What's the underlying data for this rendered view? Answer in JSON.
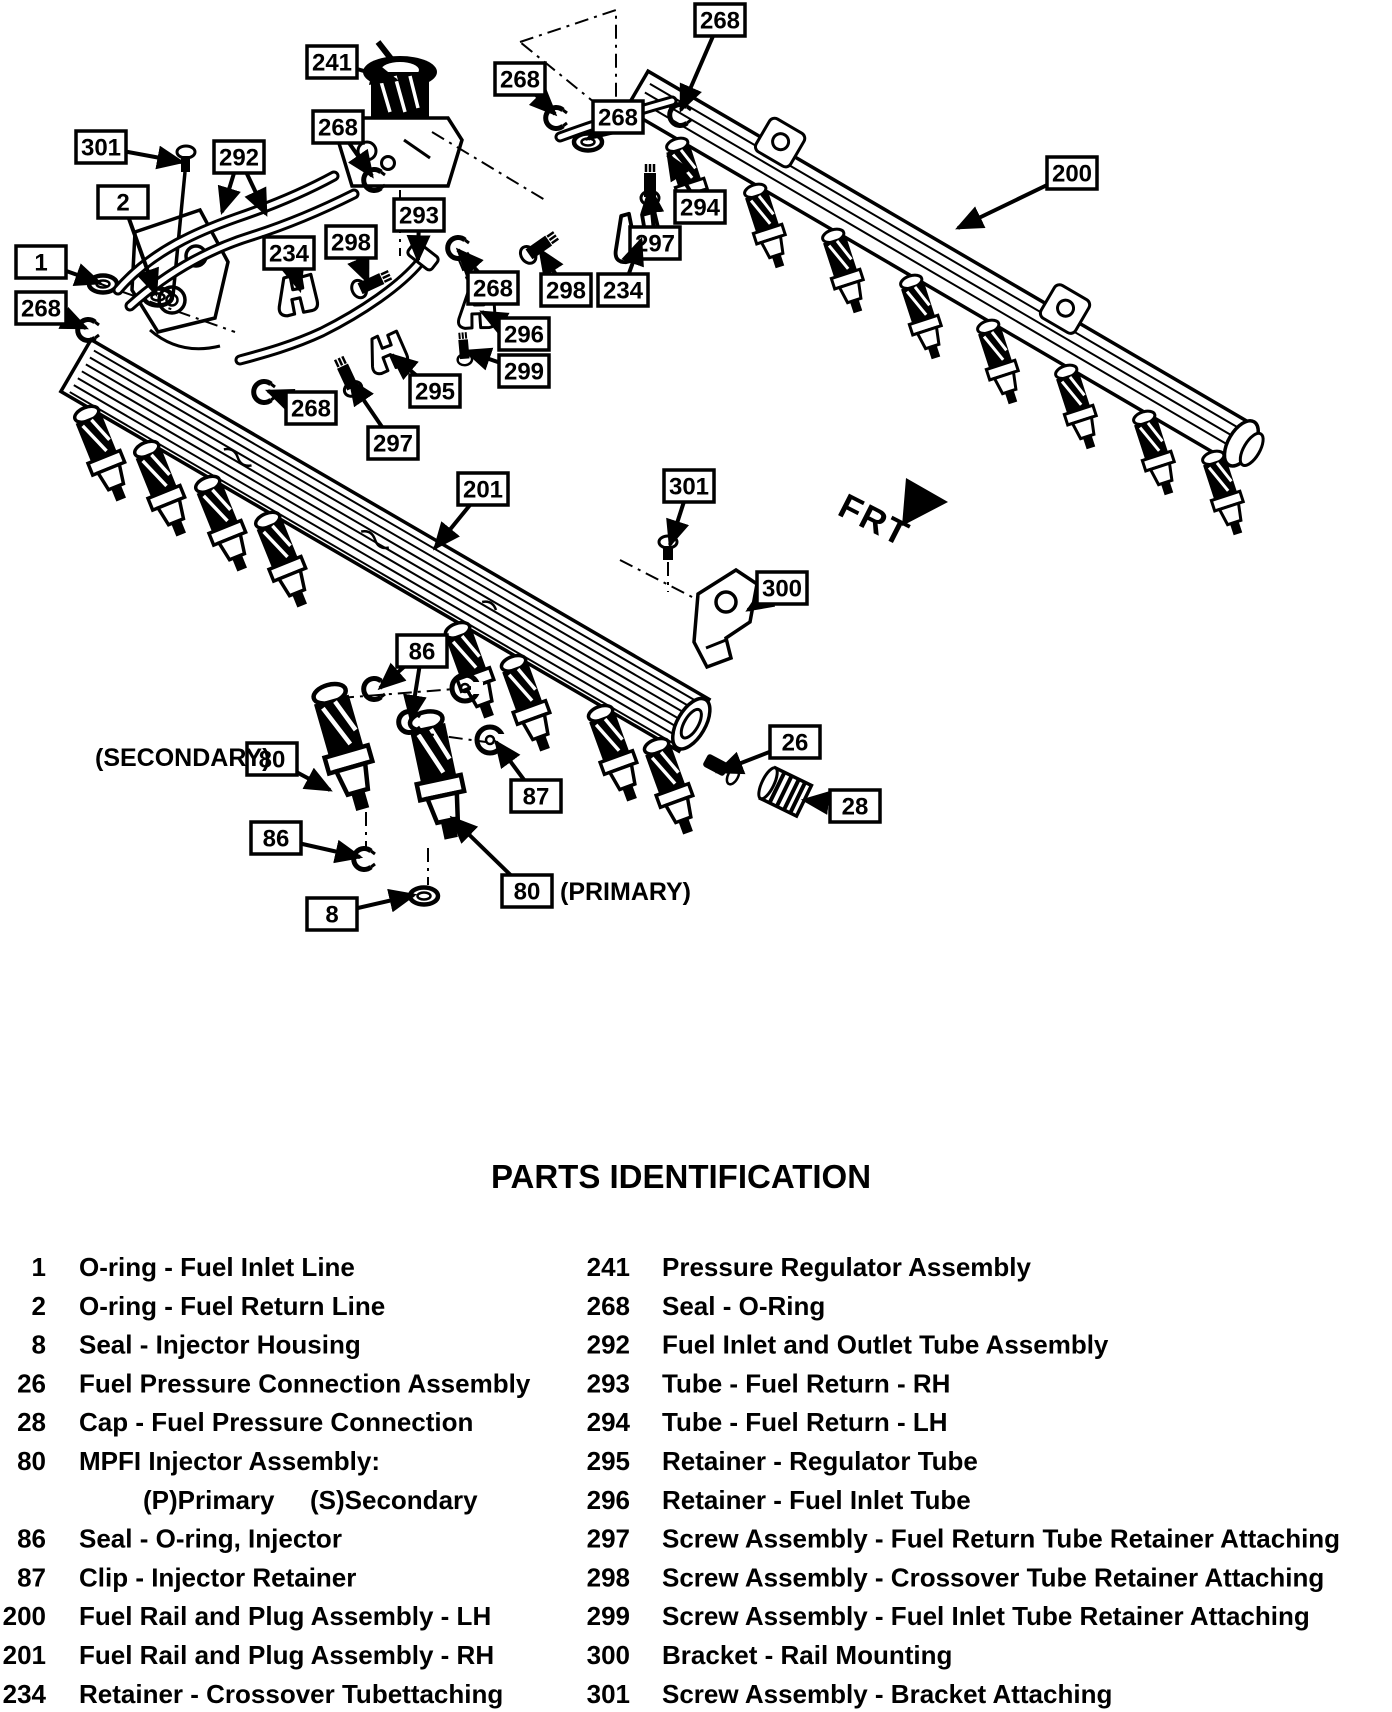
{
  "figure": {
    "orientation_label": "FRT",
    "secondary_label": "(SECONDARY)",
    "primary_label": "(PRIMARY)",
    "callouts": [
      {
        "id": "241",
        "label": "241",
        "x": 332,
        "y": 62,
        "arrows": [
          [
            396,
            80
          ]
        ]
      },
      {
        "id": "268-regulator",
        "label": "268",
        "x": 338,
        "y": 127,
        "arrows": [
          [
            372,
            176
          ]
        ]
      },
      {
        "id": "301-screw",
        "label": "301",
        "x": 101,
        "y": 147,
        "arrows": [
          [
            182,
            162
          ]
        ]
      },
      {
        "id": "292",
        "label": "292",
        "x": 239,
        "y": 157,
        "arrows": [
          [
            222,
            212
          ],
          [
            266,
            214
          ]
        ]
      },
      {
        "id": "2",
        "label": "2",
        "x": 123,
        "y": 202,
        "arrows": [
          [
            156,
            294
          ]
        ]
      },
      {
        "id": "1",
        "label": "1",
        "x": 41,
        "y": 262,
        "arrows": [
          [
            100,
            283
          ]
        ]
      },
      {
        "id": "268-left",
        "label": "268",
        "x": 41,
        "y": 308,
        "arrows": [
          [
            86,
            328
          ]
        ]
      },
      {
        "id": "293",
        "label": "293",
        "x": 419,
        "y": 215,
        "arrows": [
          [
            418,
            260
          ]
        ]
      },
      {
        "id": "234-left",
        "label": "234",
        "x": 289,
        "y": 253,
        "arrows": [
          [
            300,
            290
          ]
        ]
      },
      {
        "id": "298-left",
        "label": "298",
        "x": 351,
        "y": 242,
        "arrows": [
          [
            368,
            282
          ]
        ]
      },
      {
        "id": "268-crossover",
        "label": "268",
        "x": 493,
        "y": 288,
        "arrows": [
          [
            458,
            250
          ]
        ]
      },
      {
        "id": "296",
        "label": "296",
        "x": 524,
        "y": 334,
        "arrows": [
          [
            482,
            312
          ]
        ]
      },
      {
        "id": "299",
        "label": "299",
        "x": 524,
        "y": 371,
        "arrows": [
          [
            466,
            351
          ]
        ]
      },
      {
        "id": "295",
        "label": "295",
        "x": 435,
        "y": 391,
        "arrows": [
          [
            392,
            355
          ]
        ]
      },
      {
        "id": "268-return",
        "label": "268",
        "x": 311,
        "y": 408,
        "arrows": [
          [
            268,
            391
          ]
        ]
      },
      {
        "id": "297-return",
        "label": "297",
        "x": 393,
        "y": 443,
        "arrows": [
          [
            350,
            380
          ]
        ]
      },
      {
        "id": "268-top-mid",
        "label": "268",
        "x": 520,
        "y": 79,
        "arrows": [
          [
            555,
            114
          ]
        ]
      },
      {
        "id": "268-top-right",
        "label": "268",
        "x": 618,
        "y": 117,
        "arrows": [
          [
            588,
            139
          ]
        ]
      },
      {
        "id": "268-rail-top",
        "label": "268",
        "x": 720,
        "y": 20,
        "arrows": [
          [
            681,
            110
          ]
        ]
      },
      {
        "id": "294",
        "label": "294",
        "x": 700,
        "y": 207,
        "arrows": [
          [
            668,
            155
          ]
        ]
      },
      {
        "id": "297-right",
        "label": "297",
        "x": 655,
        "y": 243,
        "arrows": [
          [
            650,
            188
          ]
        ]
      },
      {
        "id": "234-right",
        "label": "234",
        "x": 623,
        "y": 290,
        "arrows": [
          [
            641,
            240
          ]
        ]
      },
      {
        "id": "298-right",
        "label": "298",
        "x": 566,
        "y": 290,
        "arrows": [
          [
            540,
            250
          ]
        ]
      },
      {
        "id": "200",
        "label": "200",
        "x": 1072,
        "y": 173,
        "arrows": [
          [
            958,
            228
          ]
        ]
      },
      {
        "id": "201",
        "label": "201",
        "x": 483,
        "y": 489,
        "arrows": [
          [
            435,
            548
          ]
        ]
      },
      {
        "id": "301-bracket",
        "label": "301",
        "x": 689,
        "y": 486,
        "arrows": [
          [
            670,
            545
          ]
        ]
      },
      {
        "id": "300",
        "label": "300",
        "x": 782,
        "y": 588,
        "arrows": [
          [
            748,
            610
          ]
        ]
      },
      {
        "id": "26",
        "label": "26",
        "x": 795,
        "y": 742,
        "arrows": [
          [
            718,
            772
          ]
        ]
      },
      {
        "id": "28",
        "label": "28",
        "x": 855,
        "y": 806,
        "arrows": [
          [
            804,
            800
          ]
        ]
      },
      {
        "id": "86-top",
        "label": "86",
        "x": 422,
        "y": 651,
        "arrows": [
          [
            380,
            688
          ],
          [
            411,
            720
          ]
        ]
      },
      {
        "id": "87",
        "label": "87",
        "x": 536,
        "y": 796,
        "arrows": [
          [
            496,
            742
          ]
        ]
      },
      {
        "id": "80-secondary",
        "label": "80",
        "x": 272,
        "y": 759,
        "arrows": [
          [
            330,
            790
          ]
        ]
      },
      {
        "id": "86-bottom",
        "label": "86",
        "x": 276,
        "y": 838,
        "arrows": [
          [
            360,
            857
          ]
        ]
      },
      {
        "id": "8",
        "label": "8",
        "x": 332,
        "y": 914,
        "arrows": [
          [
            414,
            895
          ]
        ]
      },
      {
        "id": "80-primary",
        "label": "80",
        "x": 527,
        "y": 891,
        "arrows": [
          [
            452,
            818
          ]
        ]
      }
    ]
  },
  "parts_list": {
    "title": "PARTS IDENTIFICATION",
    "left": [
      {
        "num": "1",
        "desc": "O-ring - Fuel Inlet Line"
      },
      {
        "num": "2",
        "desc": "O-ring - Fuel Return Line"
      },
      {
        "num": "8",
        "desc": "Seal - Injector Housing"
      },
      {
        "num": "26",
        "desc": "Fuel Pressure Connection Assembly"
      },
      {
        "num": "28",
        "desc": "Cap - Fuel Pressure Connection"
      },
      {
        "num": "80",
        "desc": "MPFI Injector Assembly:",
        "sub": [
          "(P)Primary",
          "(S)Secondary"
        ]
      },
      {
        "num": "86",
        "desc": "Seal - O-ring, Injector"
      },
      {
        "num": "87",
        "desc": "Clip - Injector Retainer"
      },
      {
        "num": "200",
        "desc": "Fuel Rail and Plug Assembly - LH"
      },
      {
        "num": "201",
        "desc": "Fuel Rail and Plug Assembly - RH"
      },
      {
        "num": "234",
        "desc": "Retainer - Crossover Tubettaching"
      }
    ],
    "right": [
      {
        "num": "241",
        "desc": "Pressure Regulator Assembly"
      },
      {
        "num": "268",
        "desc": "Seal - O-Ring"
      },
      {
        "num": "292",
        "desc": "Fuel Inlet and Outlet Tube Assembly"
      },
      {
        "num": "293",
        "desc": "Tube - Fuel Return - RH"
      },
      {
        "num": "294",
        "desc": "Tube - Fuel Return - LH"
      },
      {
        "num": "295",
        "desc": "Retainer - Regulator Tube"
      },
      {
        "num": "296",
        "desc": "Retainer - Fuel Inlet Tube"
      },
      {
        "num": "297",
        "desc": "Screw Assembly - Fuel Return Tube Retainer Attaching"
      },
      {
        "num": "298",
        "desc": "Screw Assembly - Crossover Tube Retainer Attaching"
      },
      {
        "num": "299",
        "desc": "Screw Assembly - Fuel Inlet Tube Retainer Attaching"
      },
      {
        "num": "300",
        "desc": "Bracket - Rail Mounting"
      },
      {
        "num": "301",
        "desc": "Screw Assembly - Bracket Attaching"
      }
    ]
  },
  "colors": {
    "ink": "#000000",
    "paper": "#ffffff"
  }
}
